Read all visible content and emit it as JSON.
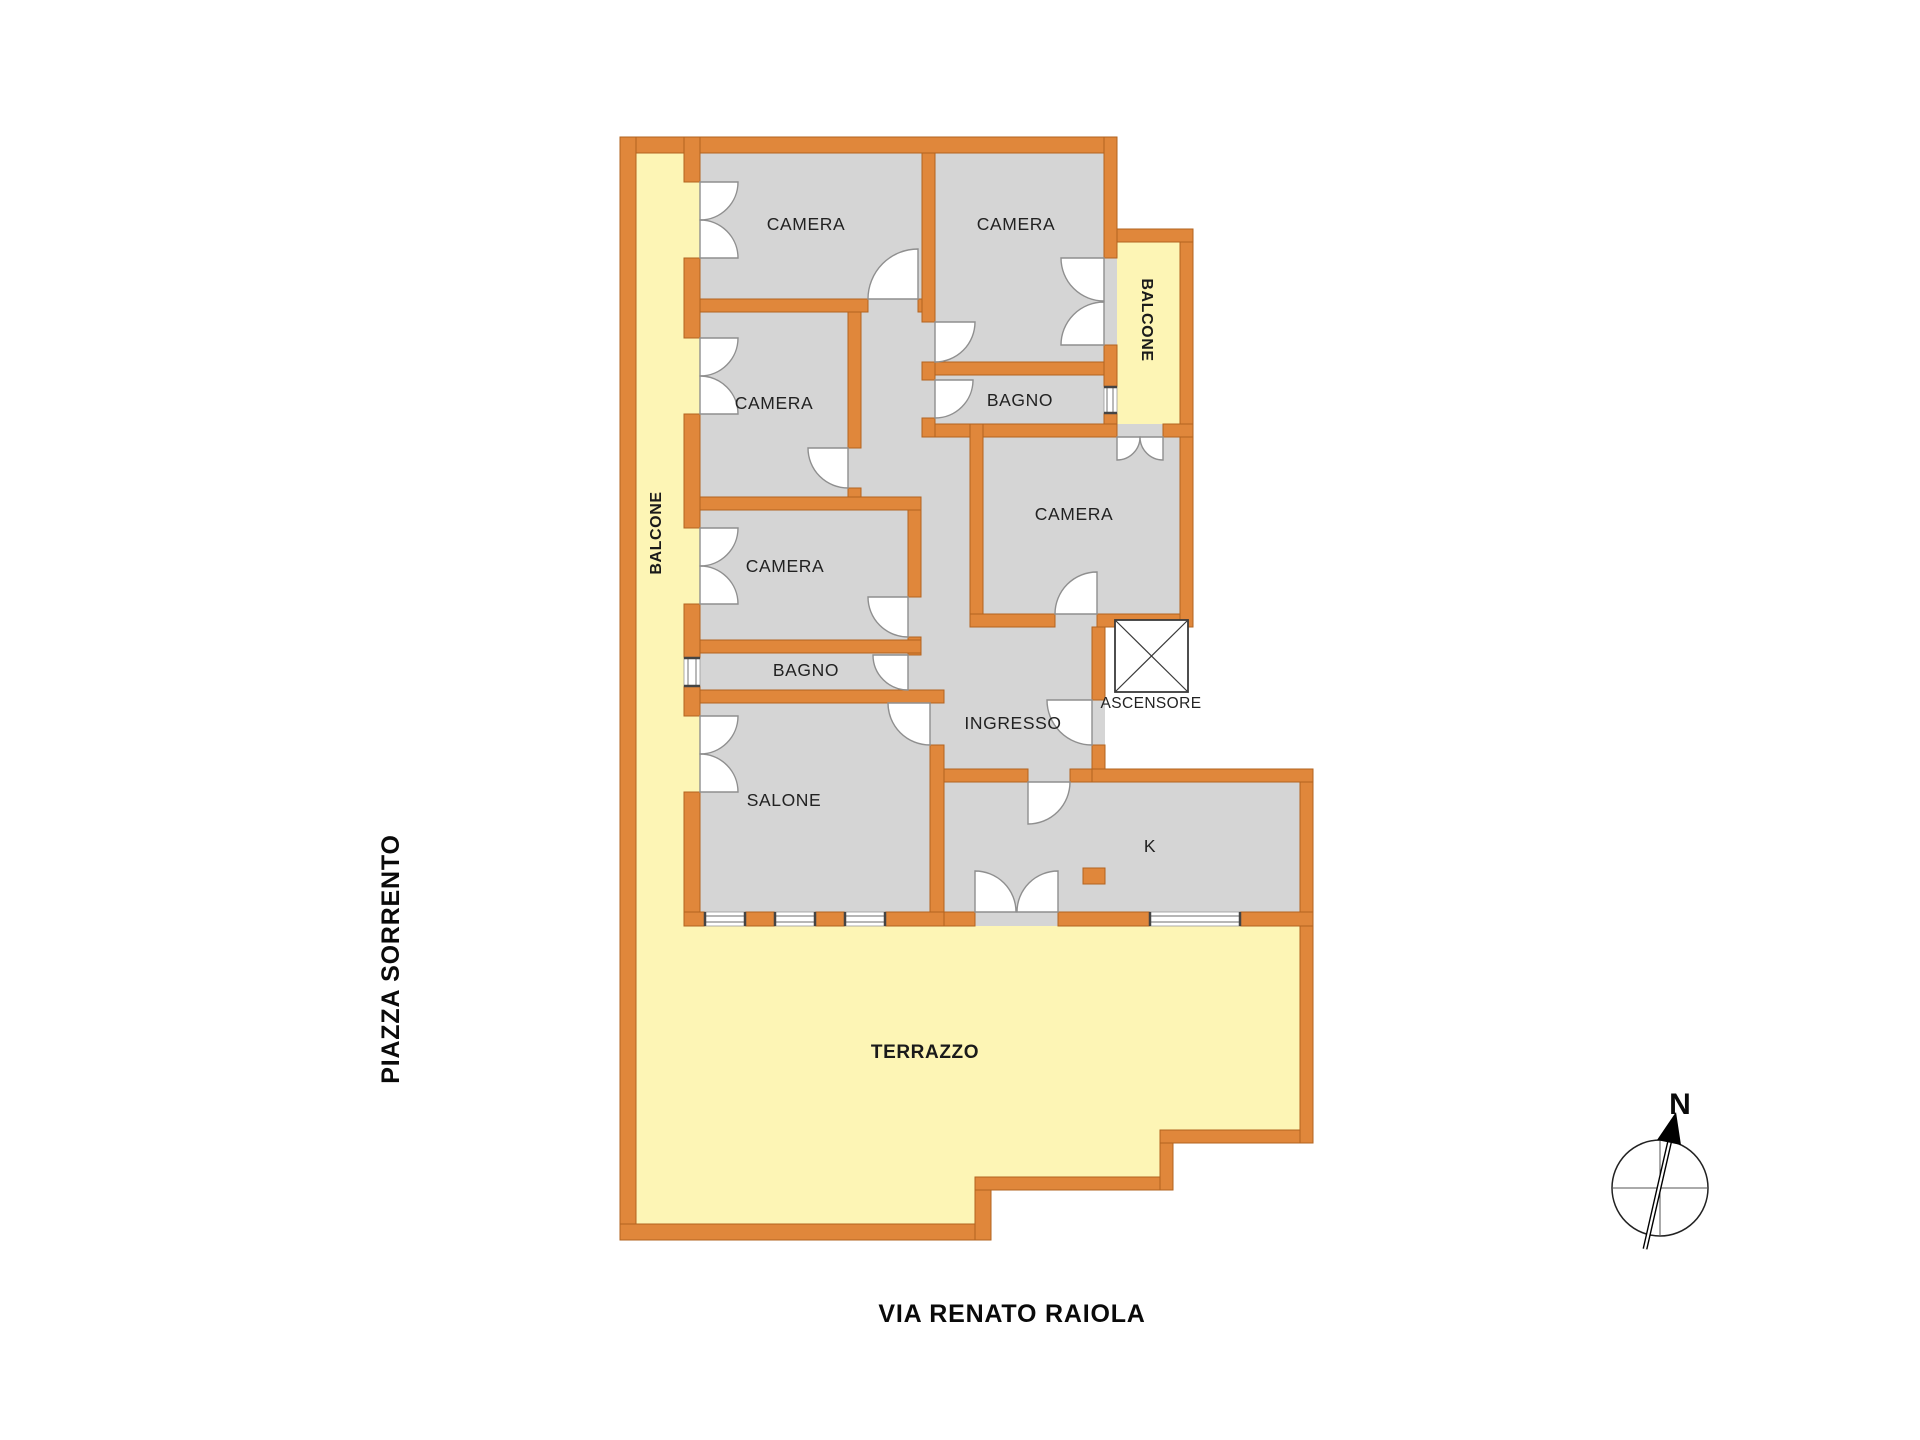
{
  "plan": {
    "colors": {
      "wall": "#E0873B",
      "wall_edge": "#B2631F",
      "room_fill": "#D5D5D5",
      "balcony_fill": "#FDF5B5",
      "door_fill": "#FFFFFF",
      "text": "#222222"
    },
    "rooms": [
      {
        "id": "camera-top-left",
        "label": "CAMERA"
      },
      {
        "id": "camera-top-middle",
        "label": "CAMERA"
      },
      {
        "id": "camera-left-middle",
        "label": "CAMERA"
      },
      {
        "id": "camera-left-lower",
        "label": "CAMERA"
      },
      {
        "id": "bagno-top",
        "label": "BAGNO"
      },
      {
        "id": "camera-middle-right",
        "label": "CAMERA"
      },
      {
        "id": "bagno-left",
        "label": "BAGNO"
      },
      {
        "id": "ingresso",
        "label": "INGRESSO"
      },
      {
        "id": "salone",
        "label": "SALONE"
      },
      {
        "id": "kitchen",
        "label": "K"
      },
      {
        "id": "ascensore",
        "label": "ASCENSORE"
      },
      {
        "id": "balcone-left",
        "label": "BALCONE"
      },
      {
        "id": "balcone-right",
        "label": "BALCONE"
      },
      {
        "id": "terrazzo",
        "label": "TERRAZZO"
      }
    ],
    "streets": {
      "left": "PIAZZA SORRENTO",
      "bottom": "VIA RENATO RAIOLA"
    },
    "compass": {
      "north_label": "N"
    }
  }
}
